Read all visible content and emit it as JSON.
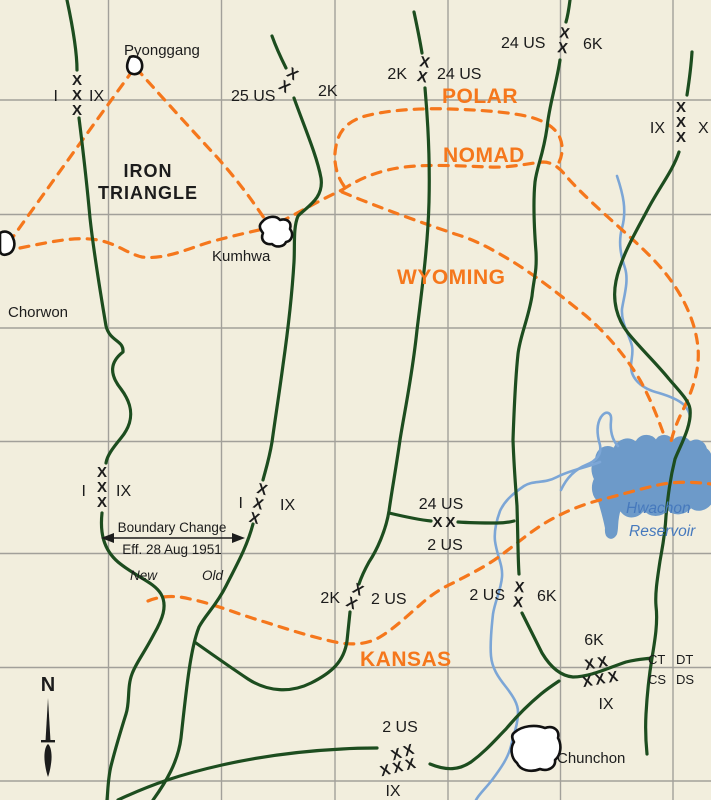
{
  "map_type": "korean-war-phase-line-map",
  "colors": {
    "background": "#f2eedd",
    "grid": "#a2a09a",
    "boundary_green": "#1d4d1f",
    "phase_line_orange": "#f5771c",
    "river_blue": "#7ca6d6",
    "reservoir_fill": "#6d9ac9",
    "water_text_blue": "#4679bd",
    "text_black": "#1c1c1c"
  },
  "phase_lines": {
    "polar": "POLAR",
    "nomad": "NOMAD",
    "wyoming": "WYOMING",
    "kansas": "KANSAS"
  },
  "region": {
    "iron_triangle_line1": "IRON",
    "iron_triangle_line2": "TRIANGLE"
  },
  "towns": {
    "pyonggang": "Pyonggang",
    "kumhwa": "Kumhwa",
    "chorwon": "Chorwon",
    "chunchon": "Chunchon"
  },
  "water": {
    "reservoir_line1": "Hwachon",
    "reservoir_line2": "Reservoir"
  },
  "annotations": {
    "boundary_change_line1": "Boundary Change",
    "boundary_change_line2": "Eff. 28 Aug 1951",
    "new_label": "New",
    "old_label": "Old",
    "north": "N"
  },
  "corner_labels": {
    "ct": "CT",
    "dt": "DT",
    "cs": "CS",
    "ds": "DS"
  },
  "markers": [
    {
      "sym": "XXX",
      "dir": "v",
      "x": 77,
      "y": 85,
      "rot": 0,
      "labels": [
        {
          "t": "I",
          "x": 58,
          "y": 101,
          "a": "end"
        },
        {
          "t": "IX",
          "x": 89,
          "y": 101,
          "a": "start"
        }
      ]
    },
    {
      "sym": "XX",
      "dir": "v",
      "x": 290,
      "y": 78,
      "rot": 32,
      "labels": [
        {
          "t": "25 US",
          "x": 231,
          "y": 101,
          "a": "start"
        },
        {
          "t": "2K",
          "x": 318,
          "y": 96,
          "a": "start"
        }
      ]
    },
    {
      "sym": "XX",
      "dir": "v",
      "x": 424,
      "y": 67,
      "rot": 10,
      "labels": [
        {
          "t": "2K",
          "x": 407,
          "y": 79,
          "a": "end"
        },
        {
          "t": "24 US",
          "x": 437,
          "y": 79,
          "a": "start"
        }
      ]
    },
    {
      "sym": "XX",
      "dir": "v",
      "x": 564,
      "y": 38,
      "rot": 8,
      "labels": [
        {
          "t": "24 US",
          "x": 501,
          "y": 48,
          "a": "start"
        },
        {
          "t": "6K",
          "x": 583,
          "y": 49,
          "a": "start"
        }
      ]
    },
    {
      "sym": "XXX",
      "dir": "v",
      "x": 681,
      "y": 112,
      "rot": 0,
      "labels": [
        {
          "t": "IX",
          "x": 665,
          "y": 133,
          "a": "end"
        },
        {
          "t": "X",
          "x": 698,
          "y": 133,
          "a": "start"
        }
      ]
    },
    {
      "sym": "XXX",
      "dir": "v",
      "x": 102,
      "y": 477,
      "rot": 0,
      "labels": [
        {
          "t": "I",
          "x": 86,
          "y": 496,
          "a": "end"
        },
        {
          "t": "IX",
          "x": 116,
          "y": 496,
          "a": "start"
        }
      ]
    },
    {
      "sym": "XXX",
      "dir": "v",
      "x": 261,
      "y": 494,
      "rot": 15,
      "labels": [
        {
          "t": "I",
          "x": 243,
          "y": 508,
          "a": "end"
        },
        {
          "t": "IX",
          "x": 280,
          "y": 510,
          "a": "start"
        }
      ]
    },
    {
      "sym": "XX",
      "dir": "h",
      "x": 444,
      "y": 527,
      "rot": 0,
      "labels": [
        {
          "t": "24 US",
          "x": 441,
          "y": 509,
          "a": "middle"
        },
        {
          "t": "2 US",
          "x": 445,
          "y": 550,
          "a": "middle"
        }
      ]
    },
    {
      "sym": "XX",
      "dir": "v",
      "x": 356,
      "y": 594,
      "rot": 25,
      "labels": [
        {
          "t": "2K",
          "x": 340,
          "y": 603,
          "a": "end"
        },
        {
          "t": "2 US",
          "x": 371,
          "y": 604,
          "a": "start"
        }
      ]
    },
    {
      "sym": "XX",
      "dir": "v",
      "x": 519,
      "y": 592,
      "rot": 5,
      "labels": [
        {
          "t": "2 US",
          "x": 505,
          "y": 600,
          "a": "end"
        },
        {
          "t": "6K",
          "x": 537,
          "y": 601,
          "a": "start"
        }
      ]
    },
    {
      "sym": "XX",
      "dir": "h",
      "x": 597,
      "y": 668,
      "rot": -10,
      "labels": [
        {
          "t": "6K",
          "x": 594,
          "y": 645,
          "a": "middle"
        }
      ]
    },
    {
      "sym": "XXX",
      "dir": "h",
      "x": 601,
      "y": 684,
      "rot": -10,
      "labels": [
        {
          "t": "IX",
          "x": 606,
          "y": 709,
          "a": "middle"
        }
      ]
    },
    {
      "sym": "XX",
      "dir": "h",
      "x": 404,
      "y": 757,
      "rot": -18,
      "labels": [
        {
          "t": "2 US",
          "x": 400,
          "y": 732,
          "a": "middle"
        }
      ]
    },
    {
      "sym": "XXX",
      "dir": "h",
      "x": 399,
      "y": 772,
      "rot": -14,
      "labels": [
        {
          "t": "IX",
          "x": 393,
          "y": 796,
          "a": "middle"
        }
      ]
    }
  ]
}
